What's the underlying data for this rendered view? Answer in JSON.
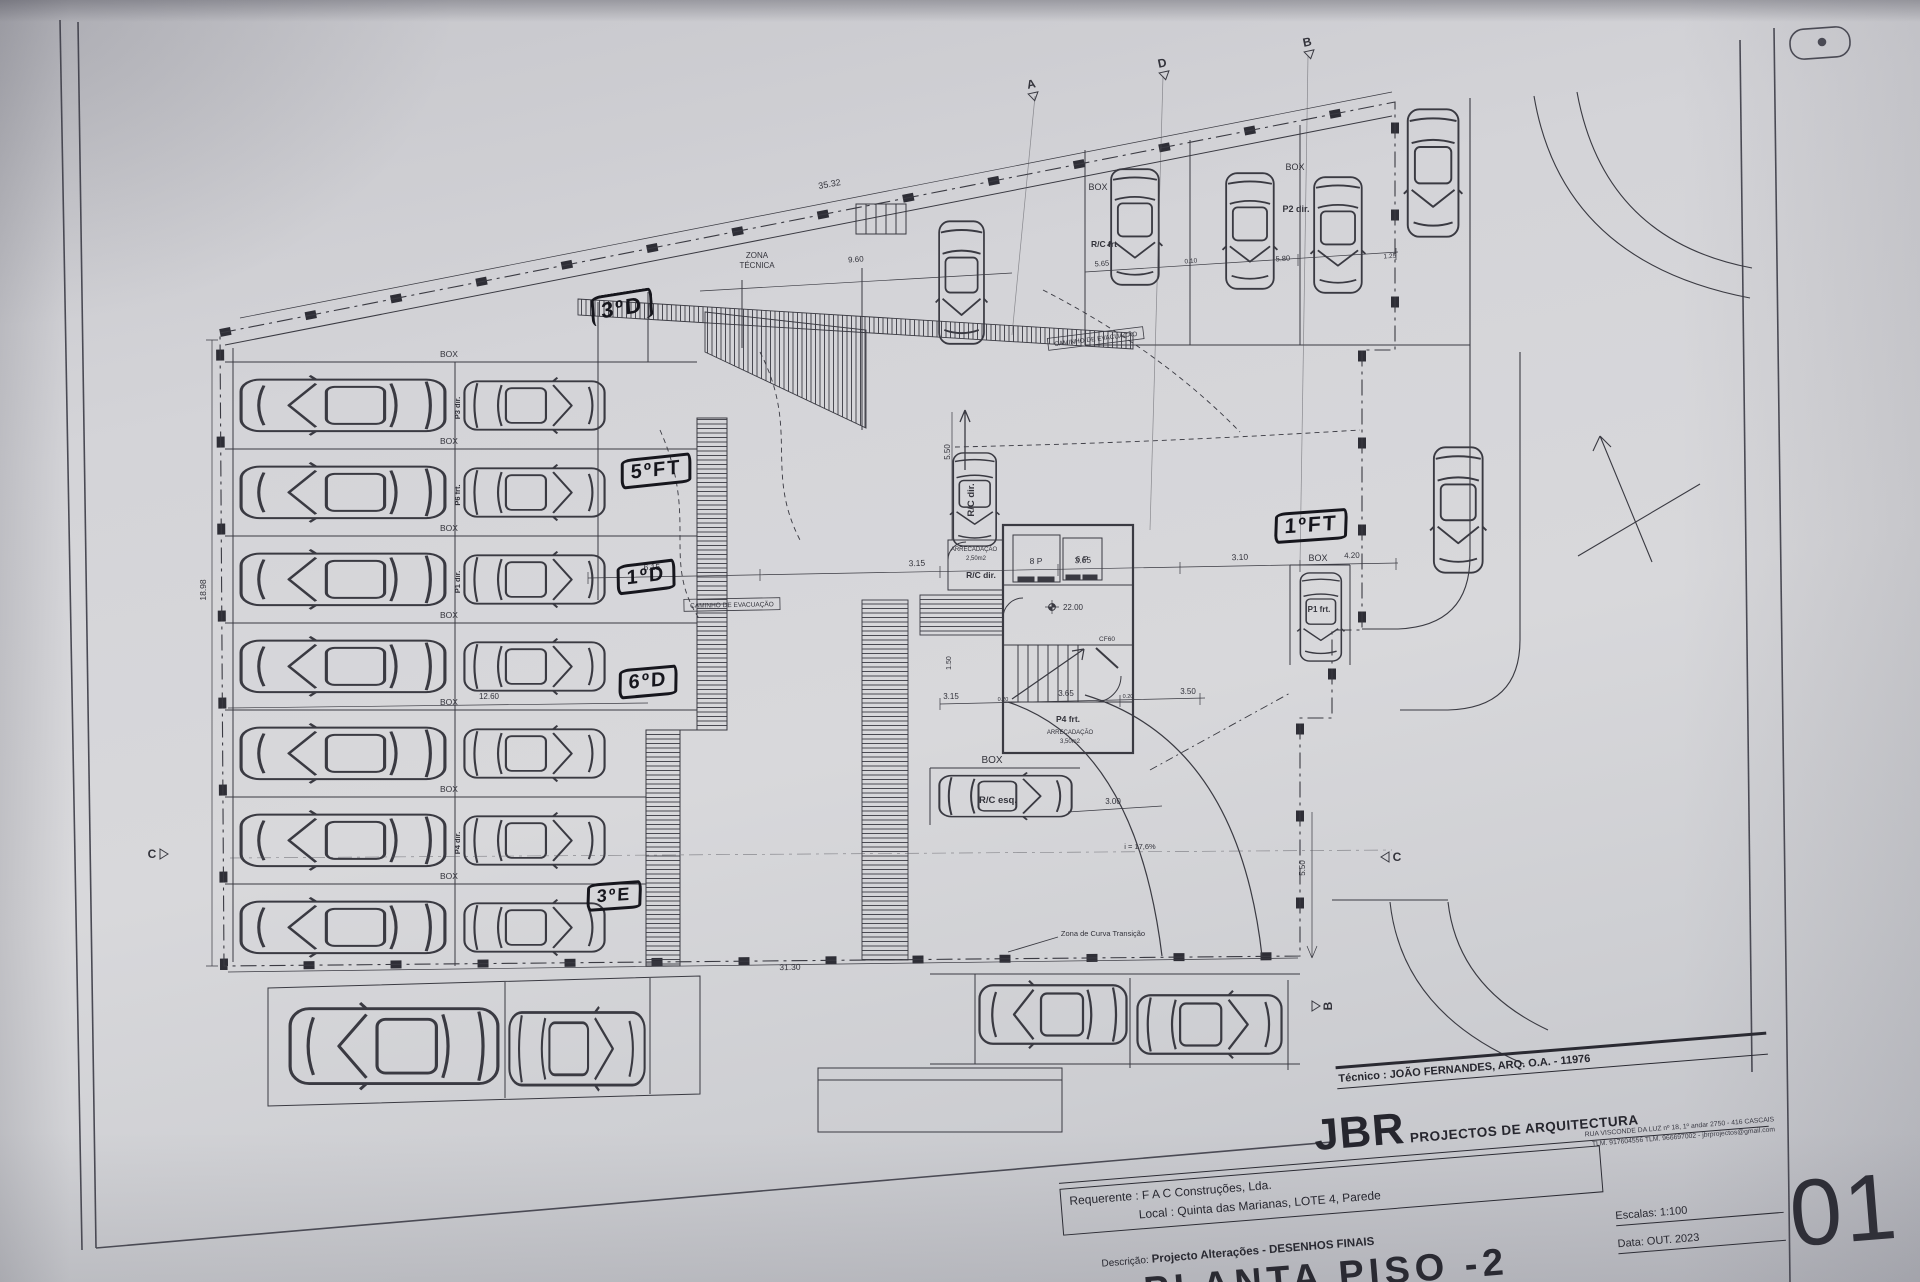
{
  "title_block": {
    "tecnico": "Técnico : JOÃO FERNANDES, ARQ.   O.A. - 11976",
    "firm_initials": "JBR",
    "firm_name": "PROJECTOS DE ARQUITECTURA",
    "firm_address": "RUA VISCONDE DA LUZ nº 18, 1º andar  2750 - 416  CASCAIS",
    "firm_contacts": "TLM. 917604556  TLM. 966697002 - jbrprojectos@gmail.com",
    "requerente": "Requerente : F A C  Construções, Lda.",
    "local": "Local : Quinta das Marianas, LOTE 4, Parede",
    "descricao_label": "Descrição:",
    "descricao_value": "Projecto Alterações - DESENHOS FINAIS",
    "drawing_title": "PLANTA PISO -2",
    "escala": "Escalas:  1:100",
    "data": "Data: OUT.  2023",
    "sheet_number": "01"
  },
  "handwritten": [
    {
      "text": "3ºD",
      "x": 622,
      "y": 307,
      "rot": -9,
      "size": 22,
      "bw": "3px 3px 0 3px"
    },
    {
      "text": "5ºFT",
      "x": 656,
      "y": 471,
      "rot": -6,
      "size": 20,
      "bw": "3px"
    },
    {
      "text": "1ºD",
      "x": 646,
      "y": 577,
      "rot": -7,
      "size": 20,
      "bw": "3px"
    },
    {
      "text": "6ºD",
      "x": 648,
      "y": 682,
      "rot": -5,
      "size": 20,
      "bw": "3px"
    },
    {
      "text": "3ºE",
      "x": 614,
      "y": 896,
      "rot": -4,
      "size": 18,
      "bw": "3px"
    },
    {
      "text": "1ºFT",
      "x": 1311,
      "y": 526,
      "rot": -4,
      "size": 21,
      "bw": "3px"
    }
  ],
  "plan": {
    "labels": [
      {
        "t": "ZONA",
        "x": 757,
        "y": 258,
        "s": 8
      },
      {
        "t": "TÉCNICA",
        "x": 757,
        "y": 268,
        "s": 8
      },
      {
        "t": "35.32",
        "x": 830,
        "y": 187,
        "s": 9,
        "r": -10
      },
      {
        "t": "9.60",
        "x": 856,
        "y": 262,
        "s": 8,
        "r": -4
      },
      {
        "t": "CAMINHO  DE  EVACUAÇÃO",
        "x": 1096,
        "y": 341,
        "s": 6.5,
        "r": -7,
        "boxed": true
      },
      {
        "t": "CAMINHO  DE  EVACUAÇÃO",
        "x": 732,
        "y": 607,
        "s": 6.5,
        "r": -1,
        "boxed": true
      },
      {
        "t": "BOX",
        "x": 1098,
        "y": 190,
        "s": 9
      },
      {
        "t": "R/C frt",
        "x": 1104,
        "y": 247,
        "s": 8.5,
        "w": "bold"
      },
      {
        "t": "BOX",
        "x": 1295,
        "y": 170,
        "s": 9
      },
      {
        "t": "P2 dir.",
        "x": 1296,
        "y": 212,
        "s": 9,
        "w": "bold"
      },
      {
        "t": "5.65",
        "x": 1102,
        "y": 266,
        "s": 7.5,
        "r": -4
      },
      {
        "t": "0.10",
        "x": 1191,
        "y": 263,
        "s": 6.5,
        "r": -4
      },
      {
        "t": "5.80",
        "x": 1283,
        "y": 261,
        "s": 7.5,
        "r": -4
      },
      {
        "t": "1.25",
        "x": 1390,
        "y": 258,
        "s": 6.5,
        "r": -4
      },
      {
        "t": "BOX",
        "x": 449,
        "y": 357,
        "s": 8.5
      },
      {
        "t": "BOX",
        "x": 449,
        "y": 444,
        "s": 8.5
      },
      {
        "t": "BOX",
        "x": 449,
        "y": 531,
        "s": 8.5
      },
      {
        "t": "BOX",
        "x": 449,
        "y": 618,
        "s": 8.5
      },
      {
        "t": "BOX",
        "x": 449,
        "y": 705,
        "s": 8.5
      },
      {
        "t": "BOX",
        "x": 449,
        "y": 792,
        "s": 8.5
      },
      {
        "t": "BOX",
        "x": 449,
        "y": 879,
        "s": 8.5
      },
      {
        "t": "P3 dir.",
        "x": 460,
        "y": 408,
        "s": 7.5,
        "r": -90,
        "w": "bold"
      },
      {
        "t": "P6 frt.",
        "x": 460,
        "y": 495,
        "s": 7.5,
        "r": -90,
        "w": "bold"
      },
      {
        "t": "P1 dir.",
        "x": 460,
        "y": 582,
        "s": 7.5,
        "r": -90,
        "w": "bold"
      },
      {
        "t": "P4 dir.",
        "x": 460,
        "y": 843,
        "s": 7.5,
        "r": -90,
        "w": "bold"
      },
      {
        "t": "12.60",
        "x": 489,
        "y": 699,
        "s": 8
      },
      {
        "t": "31.30",
        "x": 790,
        "y": 970,
        "s": 8.5,
        "r": -1
      },
      {
        "t": "18.98",
        "x": 206,
        "y": 590,
        "s": 8.5,
        "r": -90
      },
      {
        "t": "6.15",
        "x": 652,
        "y": 570,
        "s": 8.5,
        "r": -2
      },
      {
        "t": "3.15",
        "x": 917,
        "y": 566,
        "s": 8.5,
        "r": -2
      },
      {
        "t": "3.65",
        "x": 1083,
        "y": 563,
        "s": 8.5,
        "r": -2
      },
      {
        "t": "3.10",
        "x": 1240,
        "y": 560,
        "s": 8.5,
        "r": -2
      },
      {
        "t": "4.20",
        "x": 1352,
        "y": 558,
        "s": 8,
        "r": -2
      },
      {
        "t": "3.15",
        "x": 951,
        "y": 699,
        "s": 8
      },
      {
        "t": "0.20",
        "x": 1003,
        "y": 701,
        "s": 5.5
      },
      {
        "t": "3.65",
        "x": 1066,
        "y": 696,
        "s": 8
      },
      {
        "t": "0.20",
        "x": 1128,
        "y": 698,
        "s": 5.5
      },
      {
        "t": "3.50",
        "x": 1188,
        "y": 694,
        "s": 8
      },
      {
        "t": "3.00",
        "x": 1113,
        "y": 804,
        "s": 8
      },
      {
        "t": "5.50",
        "x": 950,
        "y": 452,
        "s": 8,
        "r": -90
      },
      {
        "t": "5.50",
        "x": 1305,
        "y": 868,
        "s": 8,
        "r": -90
      },
      {
        "t": "1.50",
        "x": 951,
        "y": 663,
        "s": 7,
        "r": -90
      },
      {
        "t": "8 P",
        "x": 1036,
        "y": 564,
        "s": 8.5
      },
      {
        "t": "6 P",
        "x": 1082,
        "y": 562,
        "s": 8.5
      },
      {
        "t": "22.00",
        "x": 1073,
        "y": 610,
        "s": 8
      },
      {
        "t": "CF60",
        "x": 1107,
        "y": 641,
        "s": 6.5
      },
      {
        "t": "P4 frt.",
        "x": 1068,
        "y": 722,
        "s": 8.5,
        "w": "bold"
      },
      {
        "t": "ARRECADAÇÃO",
        "x": 1070,
        "y": 734,
        "s": 6
      },
      {
        "t": "3,50m2",
        "x": 1070,
        "y": 743,
        "s": 6
      },
      {
        "t": "ARRECADAÇÃO",
        "x": 974,
        "y": 551,
        "s": 6
      },
      {
        "t": "2,50m2",
        "x": 976,
        "y": 560,
        "s": 6
      },
      {
        "t": "R/C dir.",
        "x": 981,
        "y": 578,
        "s": 8.5,
        "w": "bold"
      },
      {
        "t": "R/C dir.",
        "x": 974,
        "y": 500,
        "s": 9.5,
        "r": -90,
        "w": "bold"
      },
      {
        "t": "BOX",
        "x": 1318,
        "y": 561,
        "s": 9
      },
      {
        "t": "P1 frt.",
        "x": 1319,
        "y": 612,
        "s": 8,
        "w": "bold"
      },
      {
        "t": "BOX",
        "x": 992,
        "y": 763,
        "s": 10
      },
      {
        "t": "R/C esq.",
        "x": 998,
        "y": 803,
        "s": 9.5,
        "w": "bold"
      },
      {
        "t": "i = 17,6%",
        "x": 1140,
        "y": 849,
        "s": 7.5
      },
      {
        "t": "Zona de Curva Transição",
        "x": 1103,
        "y": 936,
        "s": 7.5
      }
    ],
    "section_markers": [
      {
        "t": "A",
        "x": 1032,
        "y": 88,
        "dir": "down",
        "r": -12
      },
      {
        "t": "D",
        "x": 1163,
        "y": 67,
        "dir": "down",
        "r": -12
      },
      {
        "t": "B",
        "x": 1308,
        "y": 46,
        "dir": "down",
        "r": -12
      },
      {
        "t": "C",
        "x": 152,
        "y": 858,
        "dir": "right",
        "r": 0
      },
      {
        "t": "C",
        "x": 1397,
        "y": 861,
        "dir": "left",
        "r": 0
      },
      {
        "t": "B",
        "x": 1332,
        "y": 1006,
        "dir": "up",
        "r": -90
      }
    ]
  }
}
